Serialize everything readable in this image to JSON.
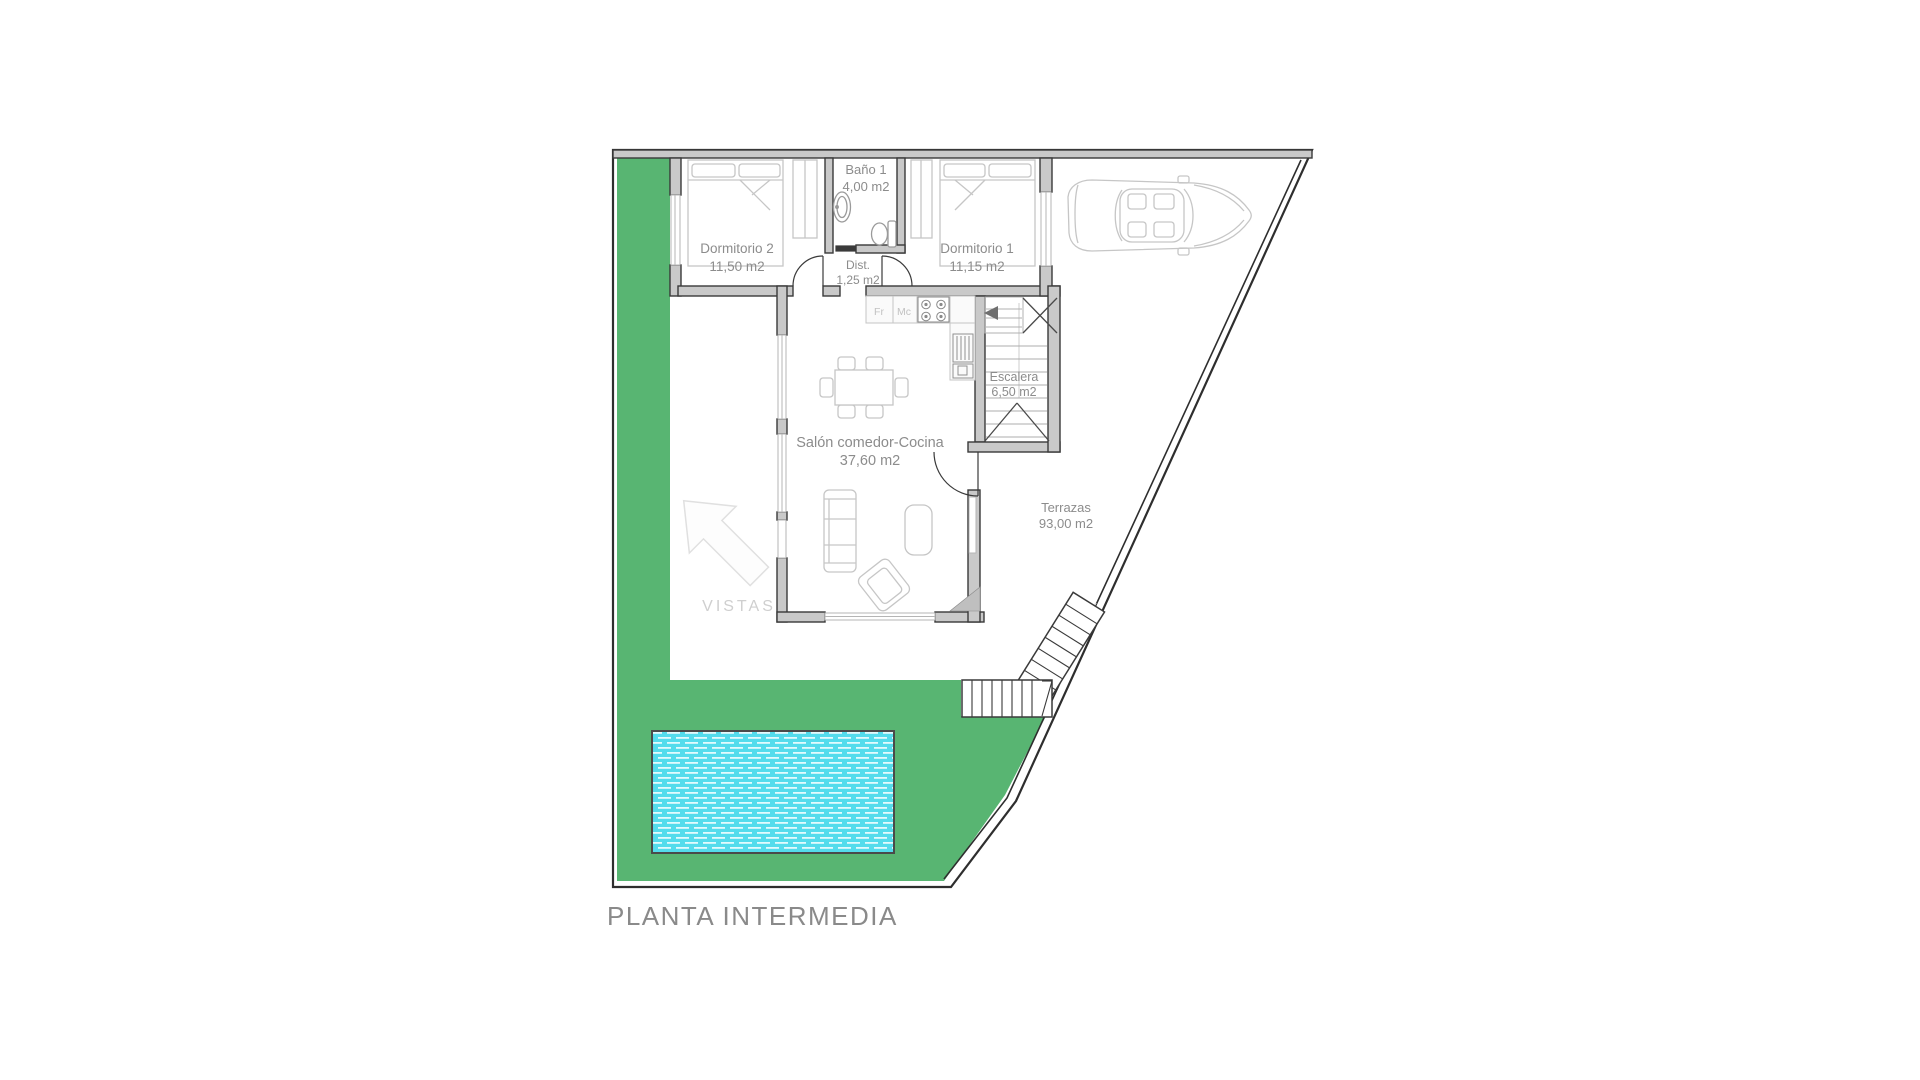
{
  "plan": {
    "title": "PLANTA INTERMEDIA",
    "rooms": {
      "dormitorio2": {
        "name": "Dormitorio 2",
        "area": "11,50 m2"
      },
      "bano1": {
        "name": "Baño 1",
        "area": "4,00 m2"
      },
      "dormitorio1": {
        "name": "Dormitorio 1",
        "area": "11,15 m2"
      },
      "dist": {
        "name": "Dist.",
        "area": "1,25 m2"
      },
      "salon": {
        "name": "Salón comedor-Cocina",
        "area": "37,60 m2"
      },
      "escalera": {
        "name": "Escalera",
        "area": "6,50 m2"
      },
      "terrazas": {
        "name": "Terrazas",
        "area": "93,00 m2"
      }
    },
    "kitchen": {
      "fr": "Fr",
      "mc": "Mc"
    },
    "vistas_label": "VISTAS",
    "colors": {
      "grass": "#58b572",
      "pool": "#54dcec",
      "pool_dash": "#e2fbfd",
      "wall_fill": "#c9c9c9",
      "wall_line": "#3a3a3a",
      "boundary": "#2e2e2e",
      "label": "#8c8c8c",
      "furniture": "#c6c6c6"
    }
  }
}
